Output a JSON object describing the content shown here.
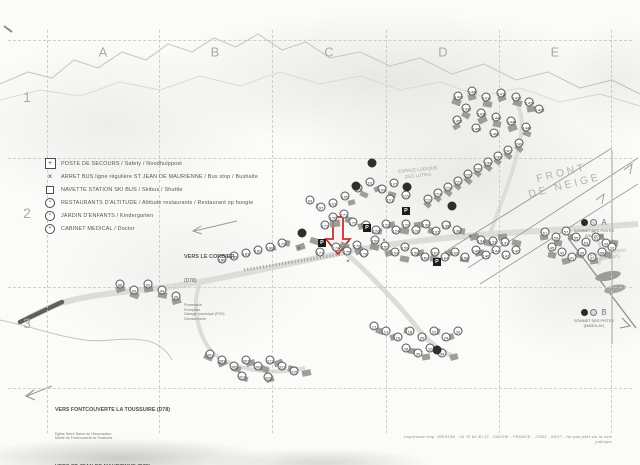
{
  "grid": {
    "columns": [
      "A",
      "B",
      "C",
      "D",
      "E"
    ],
    "rows": [
      "1",
      "2",
      "3"
    ]
  },
  "legend": {
    "items": [
      {
        "icon": "first-aid-icon",
        "label": "POSTE DE SECOURS / Safety / Noodhulppost"
      },
      {
        "icon": "bus-stop-icon",
        "label": "ARRET BUS ligne régulière ST JEAN DE MAURIENNE / Bus stop / Bushalte"
      },
      {
        "icon": "shuttle-icon",
        "label": "NAVETTE STATION SKI BUS / Skibus / Shuttle"
      },
      {
        "icon": "restaurant-icon",
        "label": "RESTAURANTS D'ALTITUDE / Altitude restaurants / Restaurant op hoogte"
      },
      {
        "icon": "kindergarten-icon",
        "label": "JARDIN D'ENFANTS / Kindergarten"
      },
      {
        "icon": "medical-icon",
        "label": "CABINET MEDICAL / Doctor"
      }
    ]
  },
  "area_labels": {
    "front_de_neige": "FRONT\nDE NEIGE",
    "espace_ludique": "ESPACE LUDIQUE\nDES LUTINS",
    "retenues": "RETENUES D'EAU\n(GOLERET)"
  },
  "lifts": {
    "a": {
      "letter": "A",
      "caption": "SOMMET DES PISTES\n(VILLARD)"
    },
    "b": {
      "letter": "B",
      "caption": "SOMMET DES PISTES\n(MAROLAY)"
    }
  },
  "directions": {
    "corbier": {
      "title": "VERS LE CORBIER",
      "road": "(D78)",
      "sub": [
        "Pharmacie",
        "Pompiers",
        "Garage municipal (P2V)",
        "Gendarmerie"
      ]
    },
    "fontcouverte": {
      "title": "VERS FONTCOUVERTE LA TOUSSUIRE (D78)",
      "sub": [
        "Eglise Notre Dame de l'Assomption",
        "Mairie de Fontcouverte-la-Toussuire"
      ]
    },
    "stjean": {
      "title": "VERS ST JEAN DE MAURIENNE (D78)"
    }
  },
  "footer": {
    "imprint": "Impression Imp. GRISONI - 04 79 64 30 12 - SAVOIE - FRANCE - 73302 - 06/17 - Ne pas jeter sur la voie publique"
  },
  "map": {
    "parking_label": "P",
    "bus_cross_glyph": "×",
    "markers": [
      [
        458,
        96,
        "1402"
      ],
      [
        472,
        91,
        "1406"
      ],
      [
        486,
        97,
        "1411"
      ],
      [
        501,
        93,
        "1415"
      ],
      [
        516,
        97,
        "1420"
      ],
      [
        529,
        102,
        "1424"
      ],
      [
        539,
        109,
        "1428"
      ],
      [
        466,
        108,
        "1432"
      ],
      [
        481,
        113,
        "1436"
      ],
      [
        496,
        117,
        "1440"
      ],
      [
        511,
        121,
        "1444"
      ],
      [
        526,
        127,
        "1448"
      ],
      [
        457,
        120,
        "1452"
      ],
      [
        476,
        128,
        "1456"
      ],
      [
        494,
        133,
        "1460"
      ],
      [
        519,
        143,
        "246"
      ],
      [
        508,
        150,
        "242"
      ],
      [
        498,
        156,
        "238"
      ],
      [
        488,
        162,
        "234"
      ],
      [
        478,
        168,
        "230"
      ],
      [
        468,
        174,
        "226"
      ],
      [
        458,
        181,
        "222"
      ],
      [
        448,
        187,
        "218"
      ],
      [
        438,
        193,
        "214"
      ],
      [
        428,
        199,
        "210"
      ],
      [
        358,
        188,
        "113"
      ],
      [
        370,
        182,
        "111"
      ],
      [
        382,
        189,
        "109"
      ],
      [
        394,
        183,
        "107"
      ],
      [
        345,
        196,
        "105"
      ],
      [
        333,
        203,
        "103"
      ],
      [
        390,
        199,
        "101"
      ],
      [
        310,
        200,
        "99"
      ],
      [
        321,
        207,
        "97"
      ],
      [
        406,
        195,
        "115"
      ],
      [
        333,
        217,
        "170"
      ],
      [
        344,
        214,
        "171"
      ],
      [
        353,
        222,
        "172"
      ],
      [
        325,
        225,
        "173"
      ],
      [
        336,
        247,
        "174"
      ],
      [
        347,
        251,
        "175"
      ],
      [
        357,
        245,
        "176"
      ],
      [
        320,
        252,
        "177"
      ],
      [
        364,
        253,
        "178"
      ],
      [
        375,
        240,
        "150"
      ],
      [
        385,
        246,
        "152"
      ],
      [
        395,
        252,
        "154"
      ],
      [
        405,
        247,
        "156"
      ],
      [
        415,
        252,
        "158"
      ],
      [
        425,
        257,
        "160"
      ],
      [
        435,
        252,
        "162"
      ],
      [
        445,
        257,
        "164"
      ],
      [
        455,
        252,
        "166"
      ],
      [
        465,
        257,
        "168"
      ],
      [
        457,
        230,
        "136"
      ],
      [
        446,
        225,
        "138"
      ],
      [
        436,
        231,
        "132"
      ],
      [
        426,
        224,
        "130"
      ],
      [
        416,
        230,
        "128"
      ],
      [
        406,
        224,
        "126"
      ],
      [
        396,
        230,
        "124"
      ],
      [
        386,
        224,
        "122"
      ],
      [
        376,
        230,
        "120"
      ],
      [
        366,
        225,
        "118"
      ],
      [
        476,
        250,
        "148"
      ],
      [
        486,
        255,
        "146"
      ],
      [
        496,
        250,
        "144"
      ],
      [
        506,
        255,
        "142"
      ],
      [
        516,
        250,
        "140"
      ],
      [
        481,
        240,
        "134"
      ],
      [
        493,
        241,
        "133"
      ],
      [
        505,
        242,
        "131"
      ],
      [
        282,
        243,
        "179"
      ],
      [
        270,
        247,
        "180"
      ],
      [
        258,
        250,
        "182"
      ],
      [
        246,
        253,
        "183"
      ],
      [
        234,
        256,
        "185"
      ],
      [
        222,
        259,
        "186"
      ],
      [
        545,
        232,
        "61"
      ],
      [
        556,
        237,
        "59"
      ],
      [
        566,
        231,
        "57"
      ],
      [
        576,
        237,
        "55"
      ],
      [
        586,
        242,
        "53"
      ],
      [
        596,
        237,
        "51"
      ],
      [
        606,
        243,
        "49"
      ],
      [
        552,
        247,
        "45"
      ],
      [
        562,
        252,
        "43"
      ],
      [
        572,
        257,
        "41"
      ],
      [
        582,
        252,
        "39"
      ],
      [
        592,
        257,
        "37"
      ],
      [
        602,
        252,
        "35"
      ],
      [
        612,
        247,
        "33"
      ],
      [
        374,
        326,
        "12"
      ],
      [
        386,
        331,
        "14"
      ],
      [
        398,
        337,
        "16"
      ],
      [
        410,
        331,
        "18"
      ],
      [
        422,
        337,
        "20"
      ],
      [
        434,
        331,
        "22"
      ],
      [
        446,
        337,
        "24"
      ],
      [
        458,
        331,
        "26"
      ],
      [
        406,
        348,
        "28"
      ],
      [
        418,
        353,
        "30"
      ],
      [
        430,
        348,
        "32"
      ],
      [
        442,
        353,
        "34"
      ],
      [
        210,
        354,
        "301"
      ],
      [
        222,
        360,
        "303"
      ],
      [
        234,
        366,
        "305"
      ],
      [
        246,
        360,
        "307"
      ],
      [
        258,
        366,
        "309"
      ],
      [
        270,
        360,
        "311"
      ],
      [
        282,
        366,
        "313"
      ],
      [
        294,
        371,
        "315"
      ],
      [
        242,
        376,
        "317"
      ],
      [
        268,
        377,
        "319"
      ],
      [
        120,
        284,
        "88"
      ],
      [
        134,
        290,
        "90"
      ],
      [
        148,
        284,
        "92"
      ],
      [
        162,
        290,
        "94"
      ],
      [
        176,
        296,
        "96"
      ]
    ],
    "dark_markers": [
      [
        372,
        163
      ],
      [
        356,
        186
      ],
      [
        407,
        187
      ],
      [
        452,
        206
      ],
      [
        302,
        233
      ],
      [
        437,
        350
      ]
    ],
    "parkings": [
      [
        322,
        243
      ],
      [
        367,
        228
      ],
      [
        437,
        262
      ],
      [
        406,
        211
      ]
    ],
    "bus_crosses": [
      [
        299,
        249
      ],
      [
        384,
        241
      ],
      [
        470,
        237
      ],
      [
        348,
        262
      ]
    ],
    "buildings": [
      [
        452,
        99,
        9,
        6,
        20
      ],
      [
        468,
        94,
        8,
        6,
        -15
      ],
      [
        483,
        101,
        9,
        6,
        10
      ],
      [
        498,
        96,
        8,
        5,
        -20
      ],
      [
        513,
        100,
        9,
        6,
        15
      ],
      [
        527,
        106,
        8,
        6,
        -10
      ],
      [
        462,
        112,
        8,
        6,
        30
      ],
      [
        478,
        117,
        9,
        6,
        -25
      ],
      [
        493,
        121,
        8,
        6,
        12
      ],
      [
        508,
        125,
        9,
        6,
        -18
      ],
      [
        523,
        131,
        8,
        5,
        22
      ],
      [
        453,
        124,
        7,
        5,
        -30
      ],
      [
        515,
        146,
        8,
        5,
        40
      ],
      [
        504,
        153,
        8,
        5,
        40
      ],
      [
        494,
        159,
        7,
        5,
        40
      ],
      [
        484,
        165,
        8,
        5,
        40
      ],
      [
        474,
        171,
        7,
        5,
        40
      ],
      [
        464,
        178,
        8,
        5,
        40
      ],
      [
        454,
        184,
        7,
        5,
        40
      ],
      [
        444,
        190,
        8,
        5,
        40
      ],
      [
        434,
        196,
        7,
        5,
        40
      ],
      [
        424,
        202,
        7,
        5,
        40
      ],
      [
        330,
        220,
        10,
        7,
        -8
      ],
      [
        345,
        217,
        9,
        6,
        12
      ],
      [
        358,
        223,
        9,
        6,
        -15
      ],
      [
        372,
        228,
        10,
        6,
        8
      ],
      [
        386,
        222,
        9,
        6,
        -12
      ],
      [
        400,
        228,
        9,
        6,
        10
      ],
      [
        414,
        222,
        9,
        6,
        -8
      ],
      [
        428,
        228,
        9,
        6,
        14
      ],
      [
        442,
        222,
        9,
        6,
        -10
      ],
      [
        456,
        228,
        9,
        6,
        8
      ],
      [
        470,
        234,
        9,
        6,
        -14
      ],
      [
        484,
        240,
        9,
        6,
        10
      ],
      [
        498,
        234,
        9,
        6,
        -8
      ],
      [
        512,
        240,
        9,
        6,
        12
      ],
      [
        340,
        243,
        9,
        6,
        20
      ],
      [
        355,
        248,
        9,
        6,
        -20
      ],
      [
        370,
        244,
        9,
        6,
        15
      ],
      [
        385,
        250,
        9,
        6,
        -15
      ],
      [
        400,
        256,
        9,
        6,
        10
      ],
      [
        415,
        250,
        9,
        6,
        -10
      ],
      [
        430,
        256,
        9,
        6,
        12
      ],
      [
        445,
        250,
        9,
        6,
        -12
      ],
      [
        460,
        256,
        9,
        6,
        8
      ],
      [
        475,
        250,
        9,
        6,
        -8
      ],
      [
        310,
        238,
        9,
        6,
        18
      ],
      [
        296,
        244,
        9,
        6,
        -18
      ],
      [
        282,
        240,
        8,
        6,
        12
      ],
      [
        268,
        246,
        8,
        5,
        -12
      ],
      [
        360,
        192,
        8,
        5,
        25
      ],
      [
        374,
        186,
        8,
        5,
        -25
      ],
      [
        388,
        192,
        8,
        5,
        15
      ],
      [
        348,
        200,
        7,
        5,
        -15
      ],
      [
        316,
        204,
        8,
        5,
        10
      ],
      [
        540,
        234,
        8,
        6,
        -10
      ],
      [
        554,
        240,
        8,
        6,
        10
      ],
      [
        568,
        234,
        8,
        6,
        -12
      ],
      [
        582,
        240,
        8,
        6,
        12
      ],
      [
        596,
        234,
        8,
        6,
        -8
      ],
      [
        610,
        240,
        8,
        6,
        8
      ],
      [
        548,
        252,
        8,
        6,
        14
      ],
      [
        562,
        258,
        8,
        6,
        -14
      ],
      [
        576,
        252,
        8,
        6,
        10
      ],
      [
        590,
        258,
        8,
        6,
        -10
      ],
      [
        604,
        252,
        8,
        6,
        12
      ],
      [
        376,
        328,
        8,
        6,
        20
      ],
      [
        390,
        334,
        8,
        6,
        -20
      ],
      [
        404,
        328,
        8,
        6,
        12
      ],
      [
        418,
        334,
        8,
        6,
        -12
      ],
      [
        432,
        328,
        8,
        6,
        16
      ],
      [
        446,
        334,
        8,
        6,
        -16
      ],
      [
        408,
        348,
        8,
        6,
        10
      ],
      [
        422,
        354,
        8,
        6,
        -10
      ],
      [
        436,
        348,
        8,
        6,
        14
      ],
      [
        450,
        354,
        8,
        6,
        -14
      ],
      [
        204,
        354,
        9,
        6,
        25
      ],
      [
        218,
        360,
        9,
        6,
        -25
      ],
      [
        232,
        366,
        9,
        6,
        15
      ],
      [
        246,
        360,
        9,
        6,
        -15
      ],
      [
        260,
        366,
        9,
        6,
        20
      ],
      [
        274,
        360,
        9,
        6,
        -20
      ],
      [
        288,
        366,
        9,
        6,
        12
      ],
      [
        302,
        370,
        9,
        6,
        -12
      ],
      [
        240,
        376,
        8,
        5,
        18
      ],
      [
        266,
        377,
        8,
        5,
        -18
      ],
      [
        116,
        286,
        9,
        6,
        -20
      ],
      [
        130,
        292,
        9,
        6,
        20
      ],
      [
        144,
        286,
        9,
        6,
        -12
      ],
      [
        158,
        292,
        9,
        6,
        12
      ],
      [
        172,
        298,
        9,
        6,
        -16
      ]
    ]
  },
  "colors": {
    "accent_red": "#c3342b",
    "ink": "#4a4a48",
    "paper": "#fbfbf9",
    "grid": "#c8c8c5"
  }
}
